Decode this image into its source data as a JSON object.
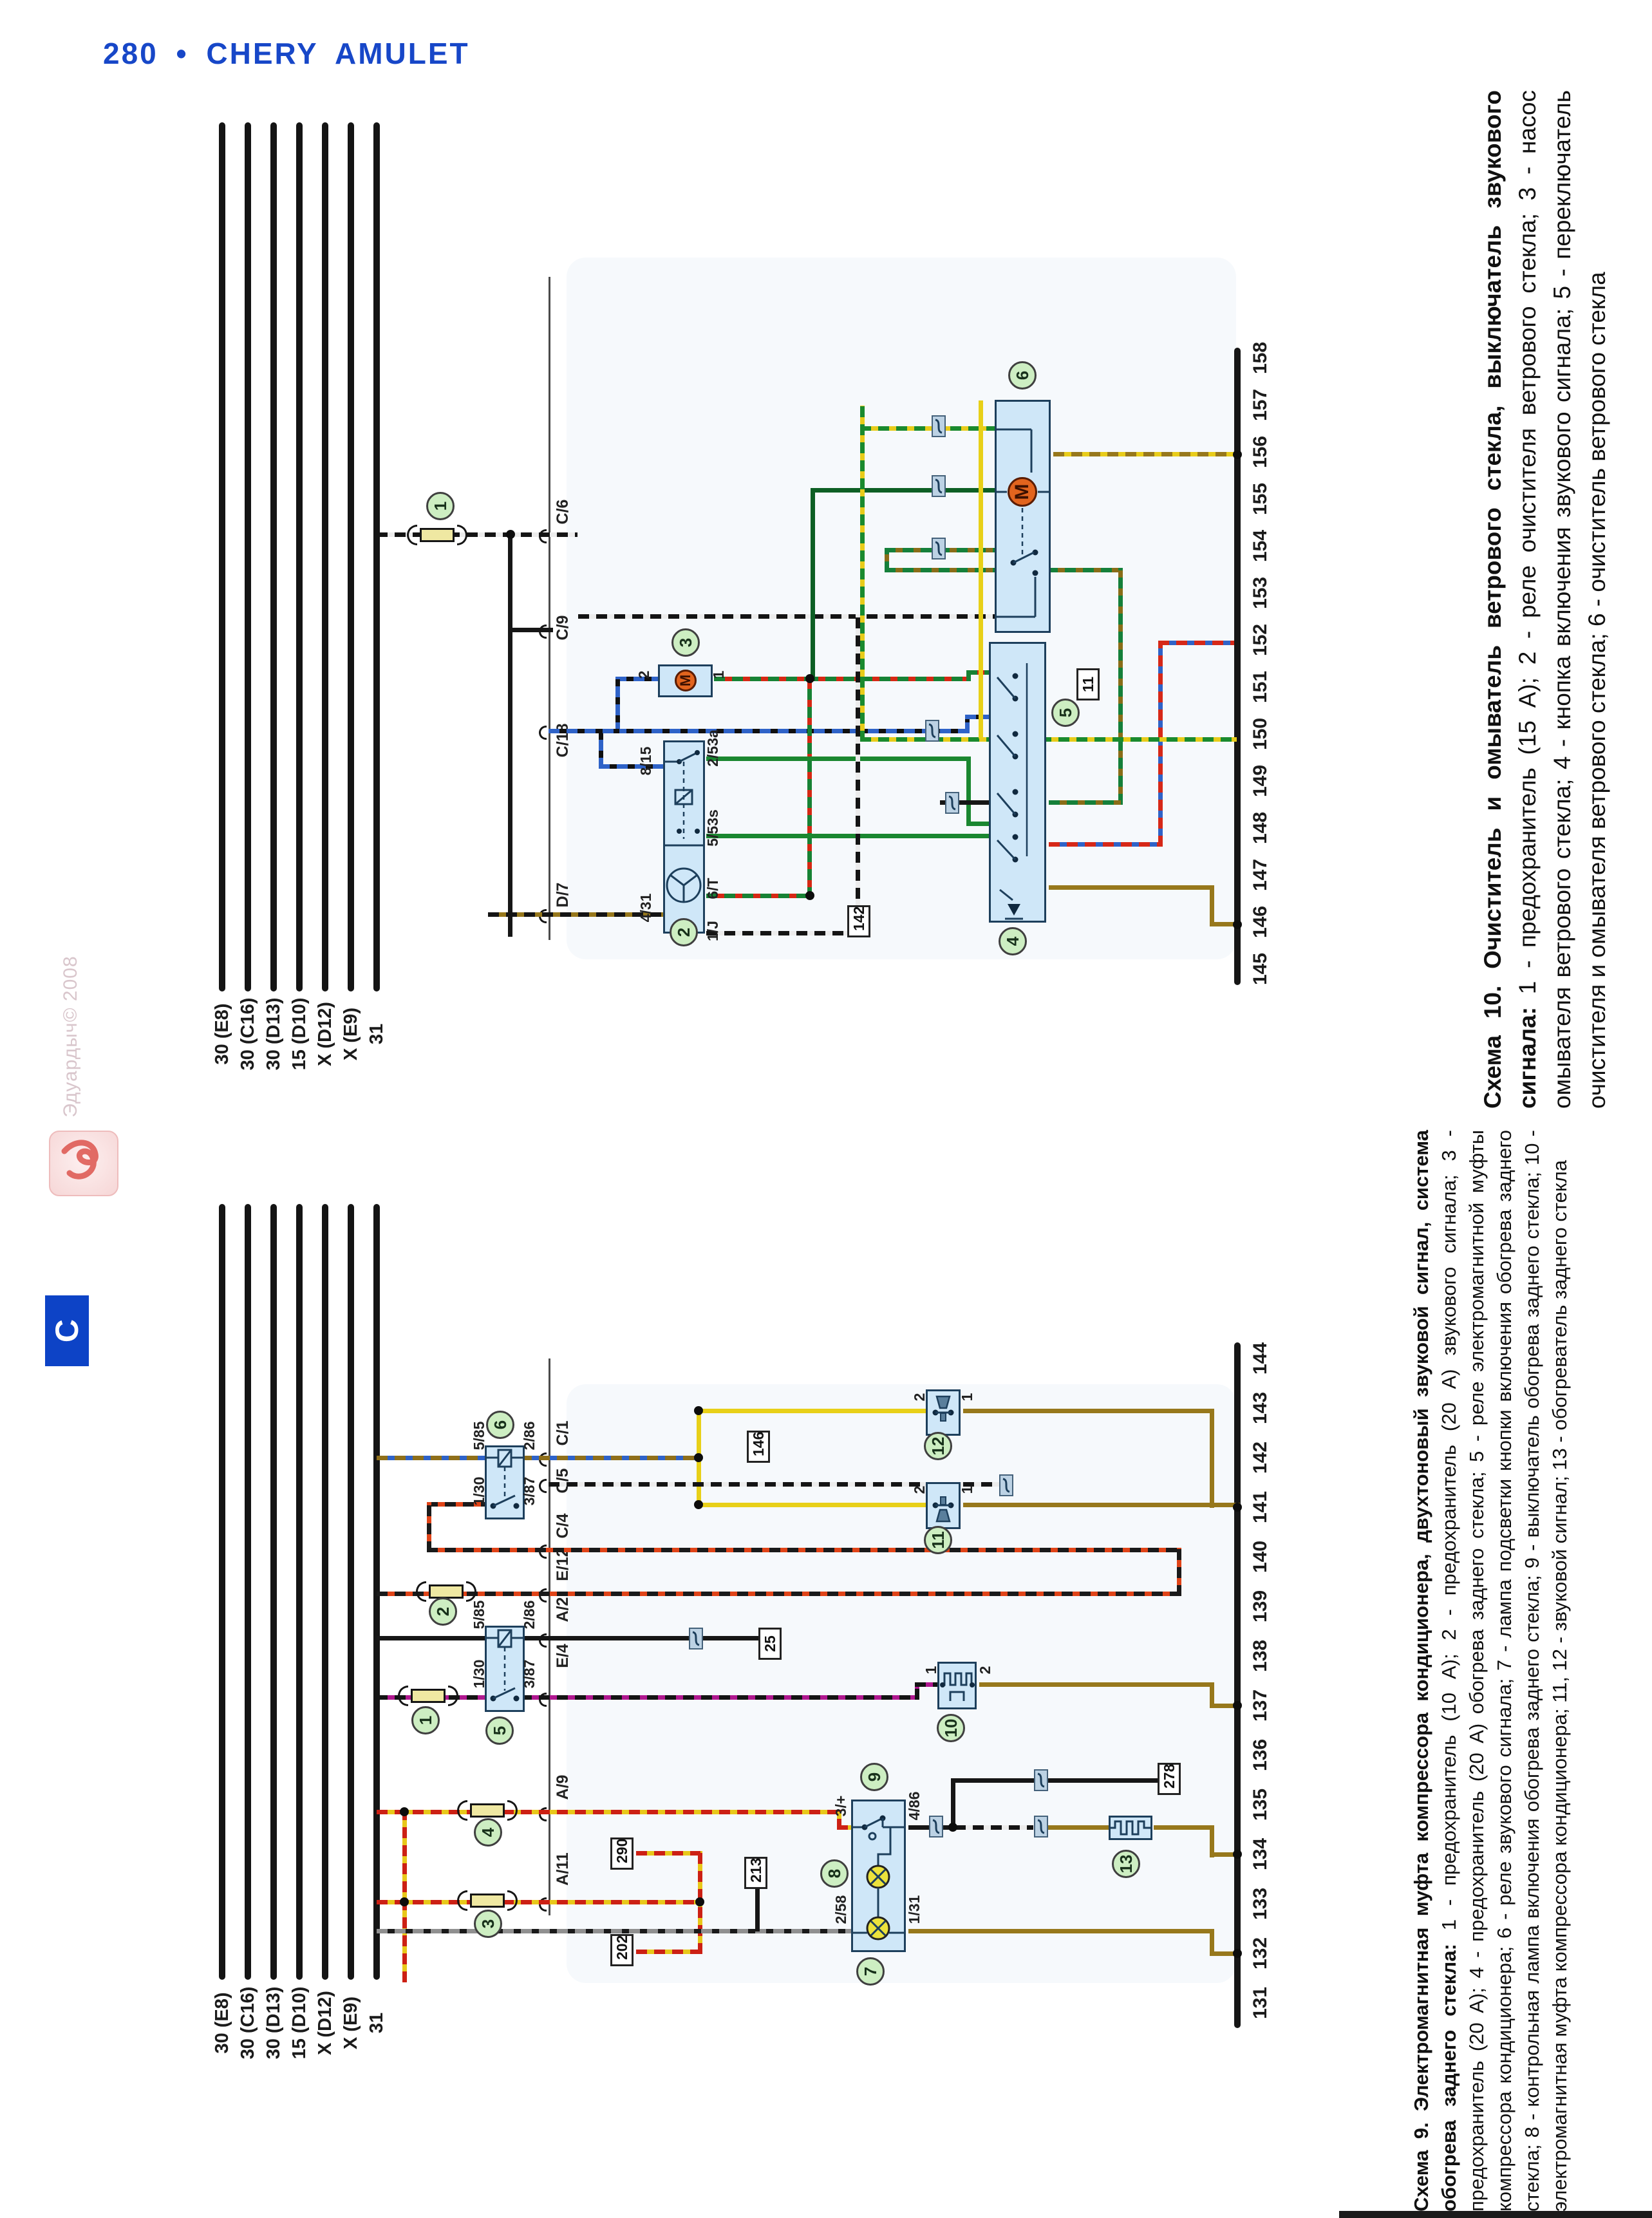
{
  "header": {
    "title": "280 • CHERY AMULET"
  },
  "watermark": {
    "text": "Эдуардыч© 2008"
  },
  "side_tab": {
    "label": "С"
  },
  "diagram10": {
    "caption_title": "Схема 10. Очиститель и омыватель ветрового стекла, выключатель звукового сигнала: ",
    "caption_body": "1 - предохранитель (15 А); 2 - реле очистителя ветрового стекла; 3 - насос омывателя ветрового стекла; 4 - кнопка включения звукового сигнала; 5 - переключатель очистителя и омывателя ветрового стекла; 6 - очиститель ветрового стекла",
    "bus_labels": [
      "30 (E8)",
      "30 (C16)",
      "30 (D13)",
      "15 (D10)",
      "X (D12)",
      "X (E9)",
      "31"
    ],
    "rail_pins": [
      "145",
      "146",
      "147",
      "148",
      "149",
      "150",
      "151",
      "152",
      "153",
      "154",
      "155",
      "156",
      "157",
      "158"
    ],
    "connectors": [
      "C/6",
      "C/9",
      "C/18",
      "D/7"
    ],
    "component_refs": [
      "1",
      "2",
      "3",
      "4",
      "5",
      "6"
    ],
    "ref_boxes": [
      "11",
      "142"
    ],
    "pin_labels": [
      "8/15",
      "4/31",
      "2/53a",
      "5/53s",
      "6/Т",
      "1/J",
      "2",
      "1"
    ],
    "motor_letter": "M"
  },
  "diagram9": {
    "caption_title": "Схема 9. Электромагнитная муфта компрессора кондиционера, двухтоновый звуковой сигнал, система обогрева заднего стекла: ",
    "caption_body": "1 - предохранитель (10 А); 2 - предохранитель (20 А) звукового сигнала; 3 - предохранитель (20 А); 4 - предохранитель (20 А) обогрева заднего стекла; 5 - реле электромагнитной муфты компрессора кондиционера; 6 - реле звукового сигнала; 7 - лампа подсветки кнопки включения обогрева заднего стекла; 8 - контрольная лампа включения обогрева заднего стекла; 9 - выключатель обогрева заднего стекла; 10 - электромагнитная муфта компрессора кондиционера; 11, 12 - звуковой сигнал; 13 - обогреватель заднего стекла",
    "bus_labels": [
      "30 (E8)",
      "30 (C16)",
      "30 (D13)",
      "15 (D10)",
      "X (D12)",
      "X (E9)",
      "31"
    ],
    "rail_pins": [
      "131",
      "132",
      "133",
      "134",
      "135",
      "136",
      "137",
      "138",
      "139",
      "140",
      "141",
      "142",
      "143",
      "144"
    ],
    "connectors": [
      "C/1",
      "C/5",
      "C/4",
      "E/12",
      "A/2",
      "E/4",
      "A/9",
      "A/11"
    ],
    "component_refs": [
      "1",
      "2",
      "3",
      "4",
      "5",
      "6",
      "7",
      "8",
      "9",
      "10",
      "11",
      "12",
      "13"
    ],
    "ref_boxes": [
      "25",
      "146",
      "213",
      "290",
      "202",
      "278"
    ],
    "pin_labels": [
      "5/85",
      "2/86",
      "1/30",
      "3/87",
      "5/85",
      "2/86",
      "1/30",
      "3/87",
      "3/+",
      "4/86",
      "2/58",
      "1/31",
      "1",
      "2",
      "2",
      "1",
      "2",
      "1"
    ]
  }
}
